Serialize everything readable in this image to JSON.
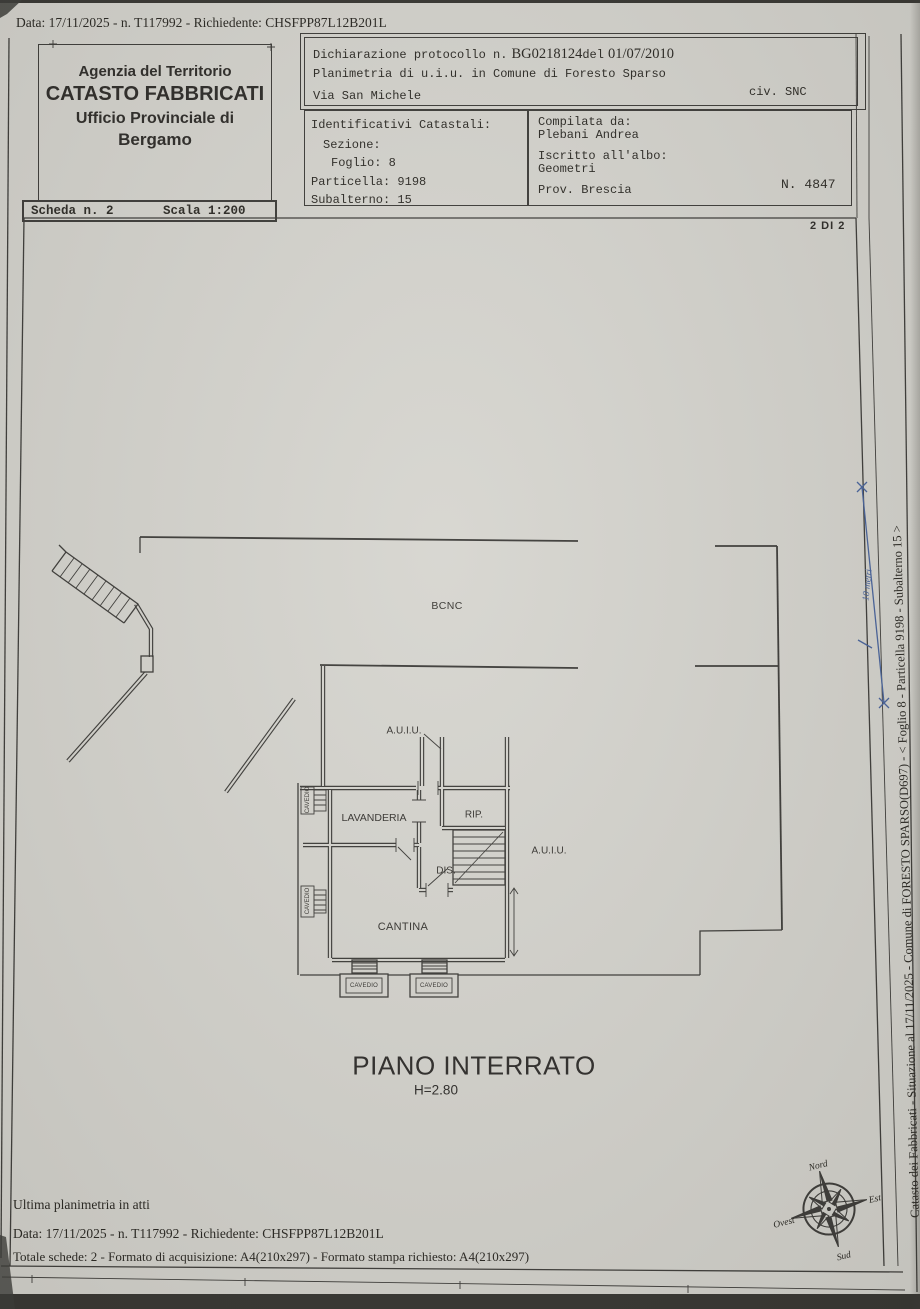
{
  "top_bar": {
    "text": "Data: 17/11/2025 - n. T117992 - Richiedente: CHSFPP87L12B201L"
  },
  "header": {
    "agency_line1": "Agenzia del Territorio",
    "agency_line2": "CATASTO FABBRICATI",
    "agency_line3": "Ufficio Provinciale di",
    "agency_line4": "Bergamo",
    "declaration": {
      "label": "Dichiarazione protocollo n.",
      "protocol": "BG0218124",
      "del_word": "del",
      "date": "01/07/2010",
      "line2": "Planimetria di u.i.u. in Comune di Foresto Sparso",
      "street": "Via San Michele",
      "civ": "civ. SNC"
    },
    "identifiers": {
      "title": "Identificativi Catastali:",
      "sezione": "Sezione:",
      "foglio": "Foglio: 8",
      "particella": "Particella: 9198",
      "subalterno": "Subalterno: 15"
    },
    "compiler": {
      "label": "Compilata da:",
      "name": "Plebani Andrea",
      "albo_label": "Iscritto all'albo:",
      "albo": "Geometri",
      "prov": "Prov. Brescia",
      "number": "N. 4847"
    },
    "scheda": {
      "n": "Scheda n. 2",
      "scala": "Scala 1:200"
    },
    "sheet_index": "2 DI 2"
  },
  "plan": {
    "labels": {
      "bcnc": "BCNC",
      "auiu_left": "A.U.I.U.",
      "auiu_right": "A.U.I.U.",
      "lavanderia": "LAVANDERIA",
      "rip": "RIP.",
      "dis": "DIS.",
      "cantina": "CANTINA",
      "cavedio": "CAVEDIO"
    },
    "floor_title": "PIANO INTERRATO",
    "floor_height": "H=2.80",
    "scale_note": "10 metri"
  },
  "side_caption": "Catasto dei Fabbricati - Situazione al 17/11/2025 - Comune di FORESTO SPARSO(D697) - <  Foglio 8 - Particella  9198 - Subalterno 15 >",
  "compass": {
    "north": "Nord",
    "east": "Est",
    "south": "Sud",
    "west": "Ovest"
  },
  "footer": {
    "line1": "Ultima planimetria in atti",
    "line2": "Data: 17/11/2025 - n. T117992 - Richiedente: CHSFPP87L12B201L",
    "line3": "Totale schede: 2 - Formato di acquisizione: A4(210x297)  - Formato stampa richiesto: A4(210x297)"
  }
}
